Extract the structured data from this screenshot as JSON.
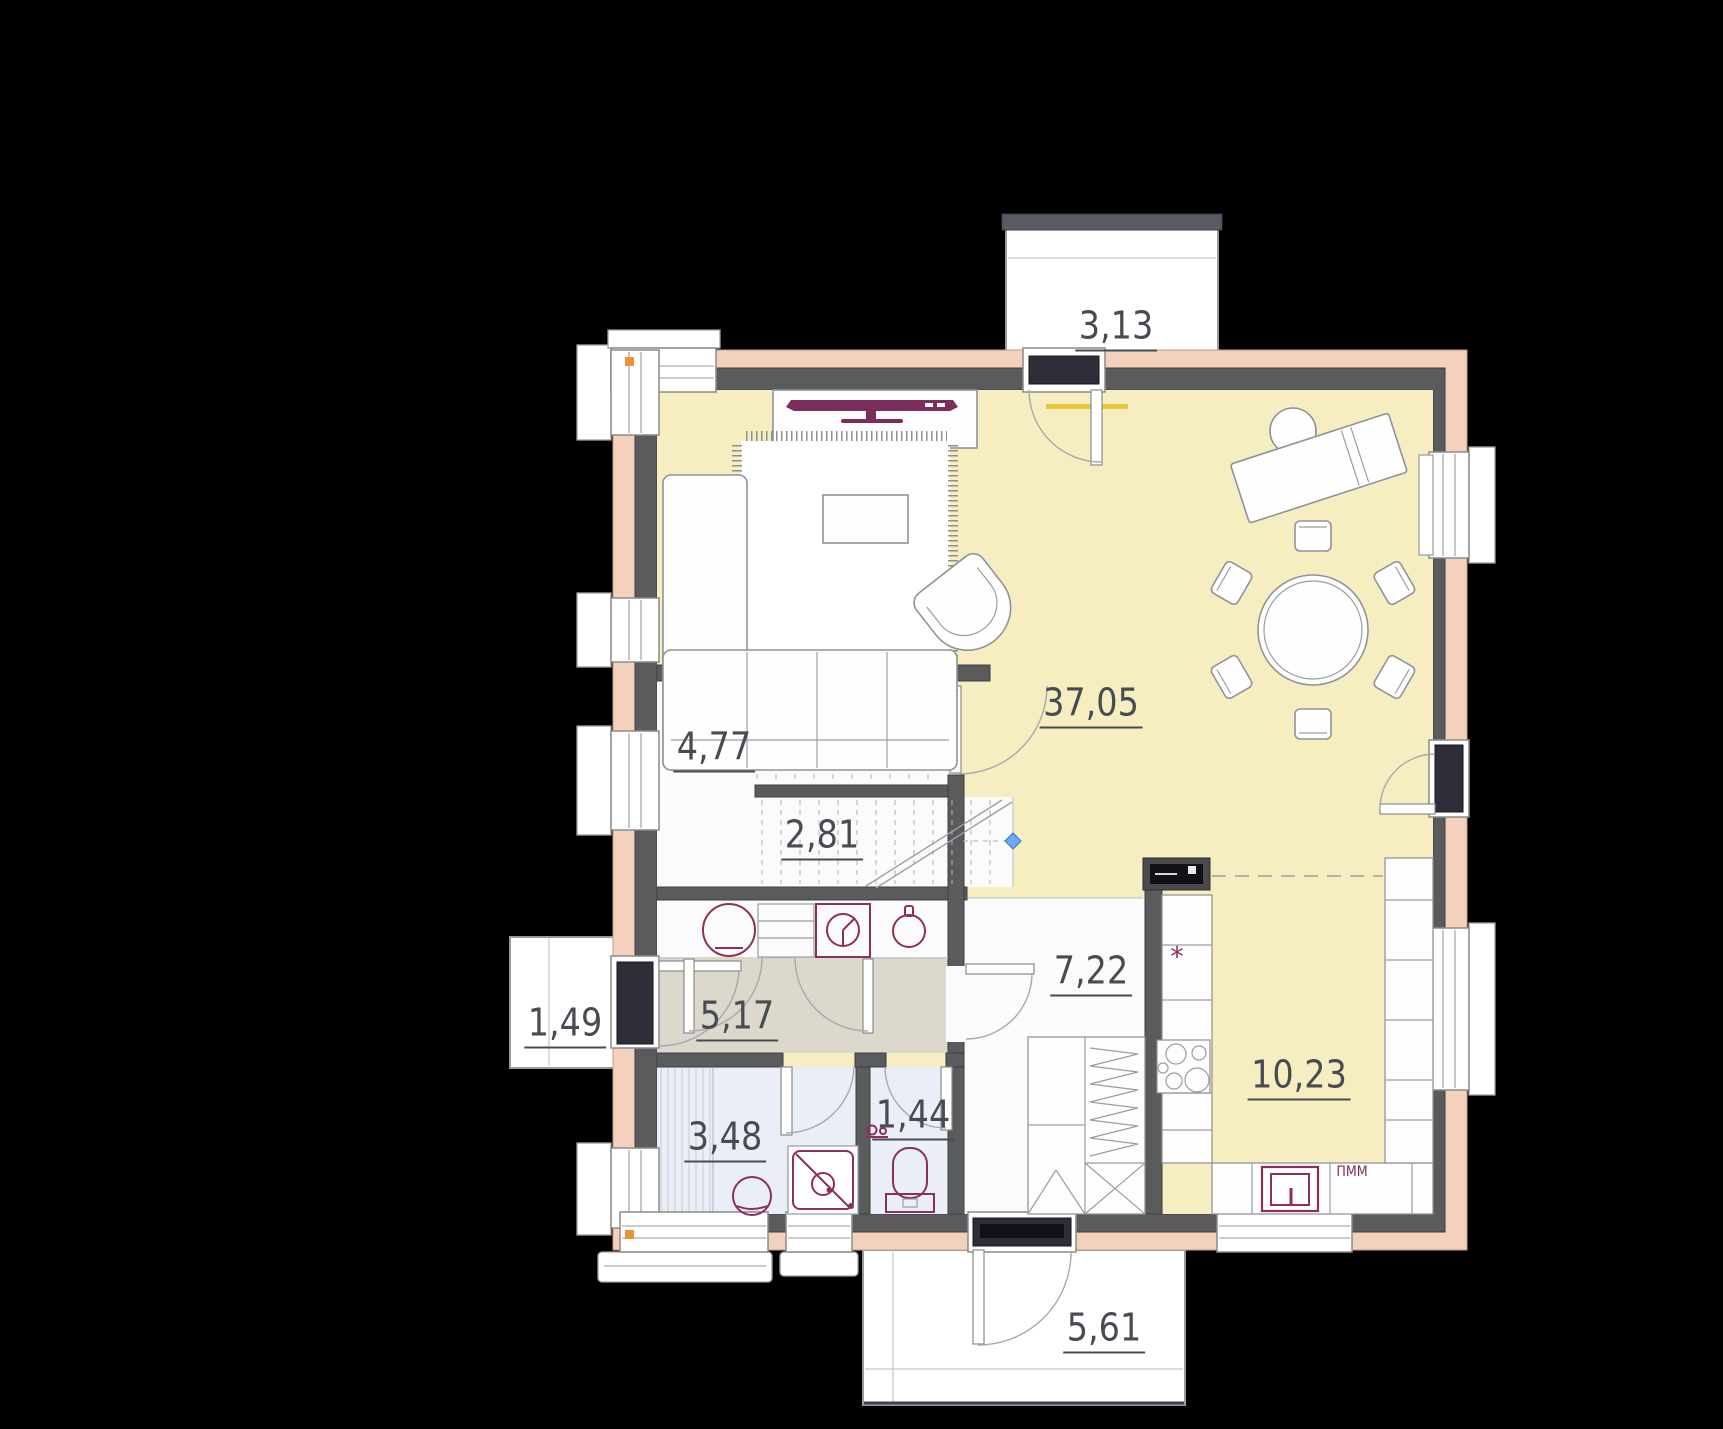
{
  "title": "apartment-first-floor-plan",
  "colors": {
    "bg": "#000000",
    "wall": "#5a5b5d",
    "insulation": "#f3d1bc",
    "floor_main": "#f6eec1",
    "floor_hall": "#dcd8cc",
    "floor_bath": "#e9eef7",
    "fixture": "#8d2f5c",
    "door_dark": "#2e2e38",
    "label": "#474c52",
    "accent_diamond": "#6fa8f5"
  },
  "plan": {
    "rooms": {
      "living_dining": {
        "area": "37,05"
      },
      "stair_storage": {
        "area": "4,77"
      },
      "stairwell": {
        "area": "2,81"
      },
      "hallway": {
        "area": "5,17"
      },
      "bathroom": {
        "area": "3,48"
      },
      "wc": {
        "area": "1,44"
      },
      "corridor": {
        "area": "7,22"
      },
      "kitchen": {
        "area": "10,23"
      },
      "balcony": {
        "area": "3,13"
      },
      "porch": {
        "area": "1,49"
      },
      "terrace": {
        "area": "5,61"
      }
    },
    "annotations": {
      "dishwasher_label": "ПММ",
      "kitchen_mark": "*"
    }
  }
}
